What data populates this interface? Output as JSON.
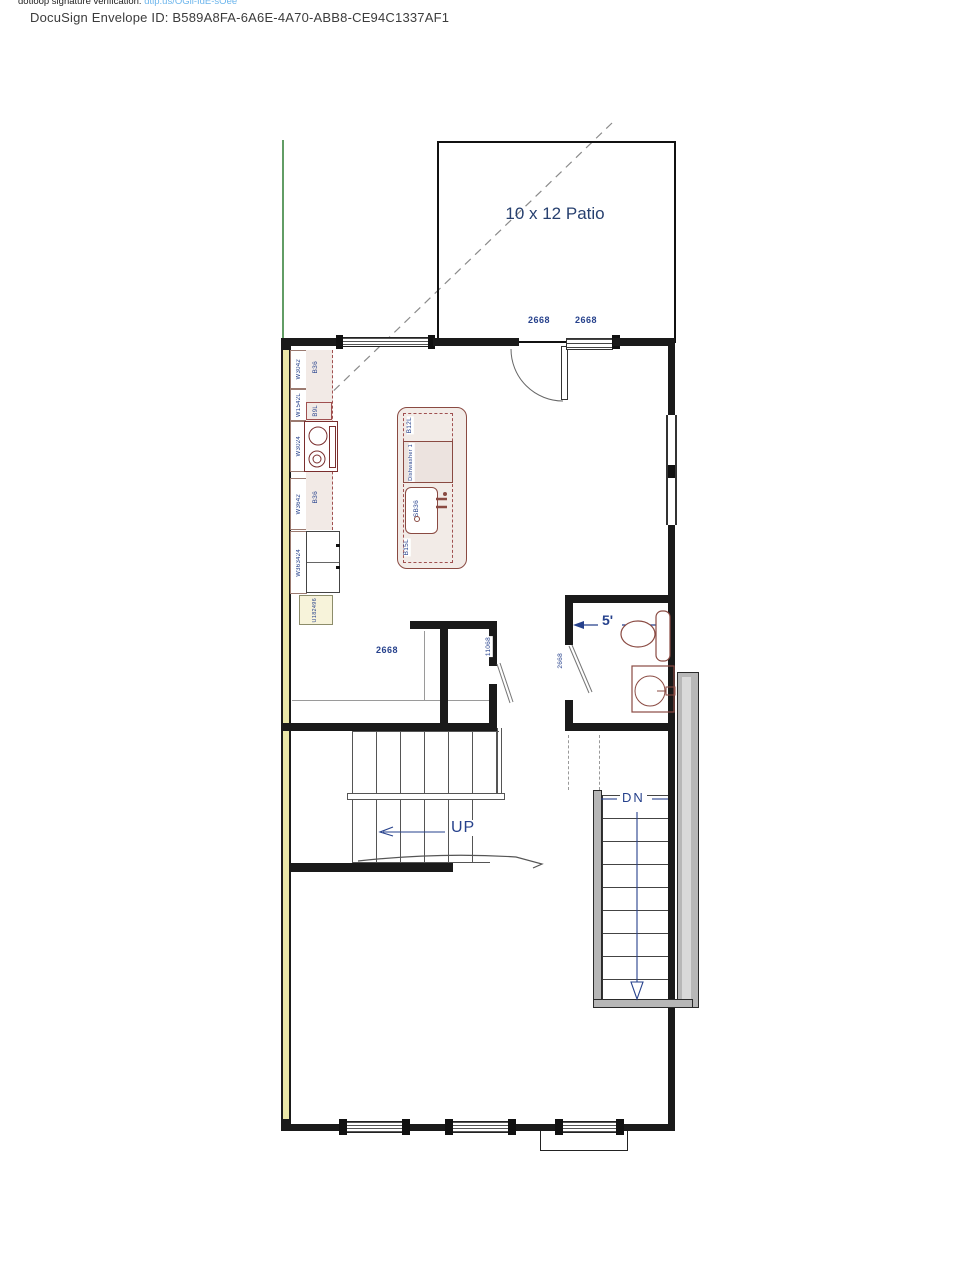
{
  "header": {
    "verification_prefix": "dotloop signature verification: ",
    "verification_link": "dtlp.us/OGli-IdE-sOee",
    "envelope": "DocuSign Envelope ID: B589A8FA-6A6E-4A70-ABB8-CE94C1337AF1"
  },
  "plan": {
    "patio": {
      "label": "10 x 12 Patio"
    },
    "doors": {
      "entry_left": "2668",
      "entry_right": "2668",
      "dining_window": "2668",
      "bath": "2668",
      "closet": "11068"
    },
    "stairs": {
      "up": "UP",
      "down": "DN"
    },
    "bath": {
      "width_dim": "5'"
    },
    "kitchen": {
      "wall_cabinets": [
        "W3042",
        "W1542L",
        "W3024",
        "W3642",
        "W363424",
        "U182496"
      ],
      "base_cabinets": [
        "B36",
        "B9L",
        "B36"
      ],
      "island": {
        "top": "B12L",
        "dishwasher": "Dishwasher 1",
        "sink": "SB36",
        "bottom": "B15L"
      }
    },
    "colors": {
      "label_navy": "#26418c",
      "cabinet_maroon": "#8a4a42",
      "party_wall_yellow": "#e9e6a8",
      "deck_gray": "#b7b7b7",
      "property_line_green": "#2e7d32",
      "link_blue": "#6cb5ec",
      "wall_black": "#1a1a1a"
    }
  }
}
